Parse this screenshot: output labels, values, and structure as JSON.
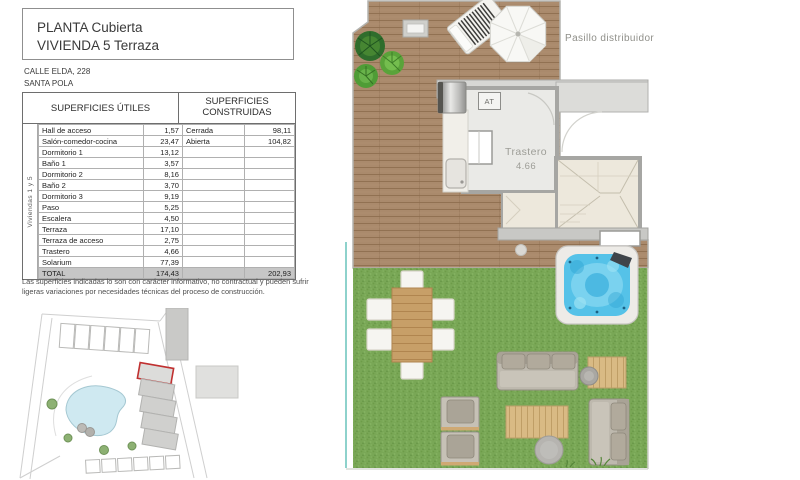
{
  "title_block": {
    "line1": "PLANTA Cubierta",
    "line2": "VIVIENDA 5 Terraza"
  },
  "address": {
    "line1": "CALLE ELDA, 228",
    "line2": "SANTA POLA"
  },
  "areas_table": {
    "header_utiles": "SUPERFICIES ÚTILES",
    "header_construidas": "SUPERFICIES CONSTRUIDAS",
    "side_label": "Viviendas 1 y 5",
    "rows": [
      {
        "name": "Hall de acceso",
        "value": "1,57",
        "cname": "Cerrada",
        "cvalue": "98,11"
      },
      {
        "name": "Salón-comedor-cocina",
        "value": "23,47",
        "cname": "Abierta",
        "cvalue": "104,82"
      },
      {
        "name": "Dormitorio 1",
        "value": "13,12",
        "cname": "",
        "cvalue": ""
      },
      {
        "name": "Baño 1",
        "value": "3,57",
        "cname": "",
        "cvalue": ""
      },
      {
        "name": "Dormitorio 2",
        "value": "8,16",
        "cname": "",
        "cvalue": ""
      },
      {
        "name": "Baño 2",
        "value": "3,70",
        "cname": "",
        "cvalue": ""
      },
      {
        "name": "Dormitorio 3",
        "value": "9,19",
        "cname": "",
        "cvalue": ""
      },
      {
        "name": "Paso",
        "value": "5,25",
        "cname": "",
        "cvalue": ""
      },
      {
        "name": "Escalera",
        "value": "4,50",
        "cname": "",
        "cvalue": ""
      },
      {
        "name": "Terraza",
        "value": "17,10",
        "cname": "",
        "cvalue": ""
      },
      {
        "name": "Terraza de acceso",
        "value": "2,75",
        "cname": "",
        "cvalue": ""
      },
      {
        "name": "Trastero",
        "value": "4,66",
        "cname": "",
        "cvalue": ""
      },
      {
        "name": "Solarium",
        "value": "77,39",
        "cname": "",
        "cvalue": ""
      }
    ],
    "total": {
      "name": "TOTAL",
      "value": "174,43",
      "cname": "",
      "cvalue": "202,93"
    }
  },
  "disclaimer": "Las superficies indicadas lo son con carácter informativo, no contractual y pueden sufrir ligeras variaciones por necesidades técnicas del proceso de construcción.",
  "plan": {
    "pasillo_label": "Pasillo distribuidor",
    "trastero_label": "Trastero",
    "trastero_area": "4.66",
    "at_label": "AT"
  },
  "colors": {
    "deck_wood": "#aa8a6c",
    "grass": "#79a756",
    "jacuzzi_water": "#55c2e8",
    "wall_gray": "#a6a6a3",
    "highlight_red": "#c03030",
    "pool_blue": "#cfe9f1",
    "label_gray": "#8f8f89"
  }
}
